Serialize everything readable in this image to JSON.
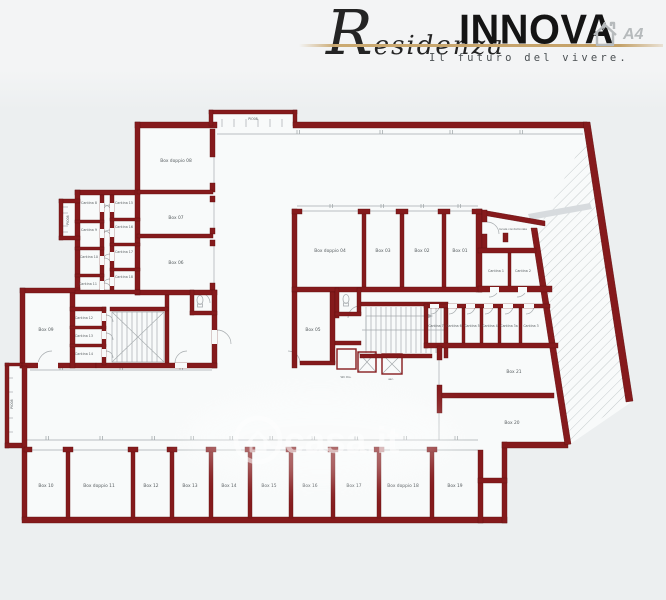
{
  "header": {
    "brand_script": "Residenza",
    "brand_main": "INNOVA",
    "tagline": "Il futuro del vivere.",
    "energy_class": "A4"
  },
  "watermark": {
    "text": "casa.it"
  },
  "colors": {
    "wall": "#851a1c",
    "gold": "#c9a76e",
    "background": "#eceff0",
    "interior": "#f8fafa"
  },
  "floorplan": {
    "labels": [
      {
        "text": "PIO08",
        "x": 253,
        "y": 120,
        "s": 3.2
      },
      {
        "text": "PIO08",
        "x": 69,
        "y": 220,
        "s": 3.2,
        "r": -90
      },
      {
        "text": "PIO08",
        "x": 13,
        "y": 404,
        "s": 3.2,
        "r": -90
      },
      {
        "text": "Box doppio 08",
        "x": 176,
        "y": 162,
        "s": 4.4
      },
      {
        "text": "Box 07",
        "x": 176,
        "y": 219,
        "s": 4.4
      },
      {
        "text": "Box 06",
        "x": 176,
        "y": 264,
        "s": 4.4
      },
      {
        "text": "Box 09",
        "x": 46,
        "y": 331,
        "s": 4.4
      },
      {
        "text": "Box 05",
        "x": 313,
        "y": 331,
        "s": 4.4
      },
      {
        "text": "Box doppio 04",
        "x": 330,
        "y": 252,
        "s": 4.4
      },
      {
        "text": "Box 03",
        "x": 383,
        "y": 252,
        "s": 4.4
      },
      {
        "text": "Box 02",
        "x": 422,
        "y": 252,
        "s": 4.4
      },
      {
        "text": "Box 01",
        "x": 460,
        "y": 252,
        "s": 4.4
      },
      {
        "text": "Cantina 1",
        "x": 496,
        "y": 272,
        "s": 3.3
      },
      {
        "text": "Cantina 2",
        "x": 523,
        "y": 272,
        "s": 3.3
      },
      {
        "text": "Cantina 7",
        "x": 436,
        "y": 327,
        "s": 3.2
      },
      {
        "text": "Cantina 6",
        "x": 454,
        "y": 327,
        "s": 3.2
      },
      {
        "text": "Cantina 5",
        "x": 472,
        "y": 327,
        "s": 3.2
      },
      {
        "text": "Cantina 4",
        "x": 490,
        "y": 327,
        "s": 3.2
      },
      {
        "text": "Cantina 3a",
        "x": 509,
        "y": 327,
        "s": 3.2
      },
      {
        "text": "Cantina 3",
        "x": 531,
        "y": 327,
        "s": 3.2
      },
      {
        "text": "Cantina 8",
        "x": 89,
        "y": 204,
        "s": 3.3
      },
      {
        "text": "Cantina 9",
        "x": 89,
        "y": 231,
        "s": 3.3
      },
      {
        "text": "Cantina 10",
        "x": 89,
        "y": 258,
        "s": 3.3
      },
      {
        "text": "Cantina 11",
        "x": 88,
        "y": 285,
        "s": 3.3
      },
      {
        "text": "Cantina 12",
        "x": 84,
        "y": 319,
        "s": 3.3
      },
      {
        "text": "Cantina 13",
        "x": 84,
        "y": 337,
        "s": 3.3
      },
      {
        "text": "Cantina 14",
        "x": 84,
        "y": 355,
        "s": 3.3
      },
      {
        "text": "Cantina 15",
        "x": 124,
        "y": 204,
        "s": 3.3
      },
      {
        "text": "Cantina 16",
        "x": 124,
        "y": 228,
        "s": 3.3
      },
      {
        "text": "Cantina 17",
        "x": 124,
        "y": 253,
        "s": 3.3
      },
      {
        "text": "Cantina 18",
        "x": 124,
        "y": 278,
        "s": 3.3
      },
      {
        "text": "Box 10",
        "x": 46,
        "y": 487,
        "s": 4.4
      },
      {
        "text": "Box doppio 11",
        "x": 99,
        "y": 487,
        "s": 4.4
      },
      {
        "text": "Box 12",
        "x": 151,
        "y": 487,
        "s": 4.4
      },
      {
        "text": "Box 13",
        "x": 190,
        "y": 487,
        "s": 4.4
      },
      {
        "text": "Box 14",
        "x": 229,
        "y": 487,
        "s": 4.4
      },
      {
        "text": "Box 15",
        "x": 269,
        "y": 487,
        "s": 4.4
      },
      {
        "text": "Box 16",
        "x": 310,
        "y": 487,
        "s": 4.4
      },
      {
        "text": "Box 17",
        "x": 354,
        "y": 487,
        "s": 4.4
      },
      {
        "text": "Box doppio 18",
        "x": 403,
        "y": 487,
        "s": 4.4
      },
      {
        "text": "Box 19",
        "x": 455,
        "y": 487,
        "s": 4.4
      },
      {
        "text": "Box 21",
        "x": 514,
        "y": 373,
        "s": 4.4
      },
      {
        "text": "Box 20",
        "x": 512,
        "y": 424,
        "s": 4.4
      },
      {
        "text": "WC Dis.",
        "x": 346,
        "y": 378,
        "s": 2.8
      },
      {
        "text": "asc.",
        "x": 391,
        "y": 380,
        "s": 2.8
      },
      {
        "text": "locale condominiale",
        "x": 513,
        "y": 230,
        "s": 2.8
      }
    ]
  }
}
